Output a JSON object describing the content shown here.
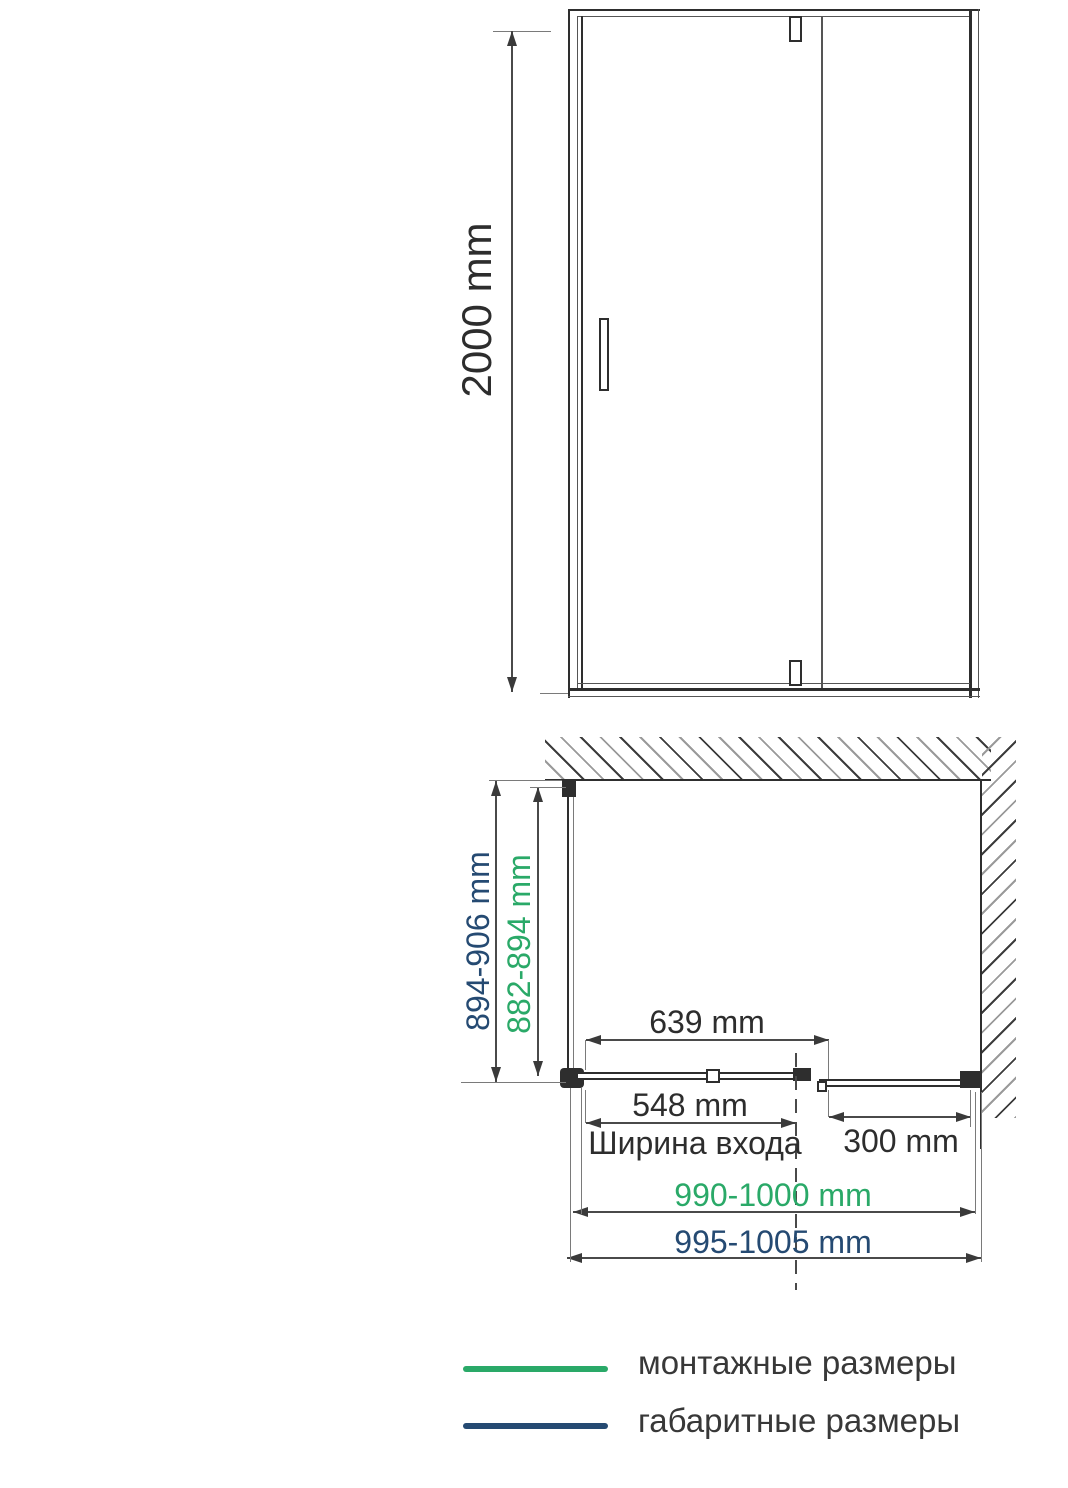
{
  "front_view": {
    "height": "2000 mm"
  },
  "plan_view": {
    "overall_depth": "894-906 mm",
    "mounting_depth": "882-894 mm",
    "door_section_width": "639 mm",
    "entry_width": "548 mm",
    "entry_caption": "Ширина входа",
    "side_panel_width": "300 mm",
    "mounting_width": "990-1000 mm",
    "overall_width": "995-1005 mm"
  },
  "legend": {
    "mounting": {
      "label": "монтажные размеры",
      "color": "#2aa968"
    },
    "overall": {
      "label": "габаритные размеры",
      "color": "#254a72"
    }
  },
  "colors": {
    "mounting_green": "#2aa968",
    "overall_navy": "#254a72",
    "drawing_line": "#2e2e2e",
    "dimension_text": "#2d2d2d"
  }
}
